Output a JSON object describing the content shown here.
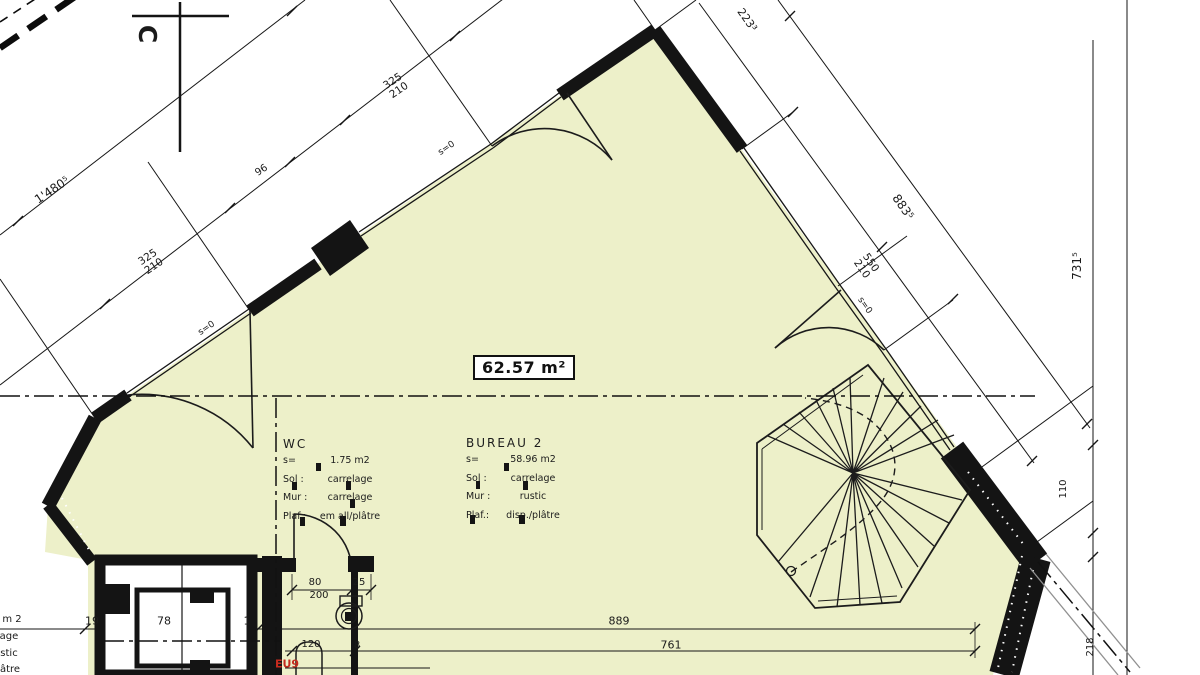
{
  "plan": {
    "area_box": "62.57 m²",
    "colors": {
      "floor": "#edf0c9",
      "line": "#161616",
      "gray": "#909090",
      "red": "#c52b1e",
      "paper": "#ffffff"
    },
    "rooms": {
      "wc": {
        "title": "WC",
        "rows": [
          [
            "s=",
            "1.75 m2"
          ],
          [
            "Sol :",
            "carrelage"
          ],
          [
            "Mur :",
            "carrelage"
          ],
          [
            "Plaf.:",
            "em all/plâtre"
          ]
        ]
      },
      "bureau": {
        "title": "BUREAU 2",
        "rows": [
          [
            "s=",
            "58.96 m2"
          ],
          [
            "Sol :",
            "carrelage"
          ],
          [
            "Mur :",
            "rustic"
          ],
          [
            "Plaf.:",
            "disp./plâtre"
          ]
        ]
      }
    },
    "dim_labels": [
      {
        "t": "C",
        "x": 147,
        "y": 34,
        "r": 90,
        "fs": 25,
        "b": 1,
        "n": "section-letter"
      },
      {
        "t": "1'480⁵",
        "x": 52,
        "y": 190,
        "r": -34,
        "fs": 12,
        "n": "dim-wall-total"
      },
      {
        "t": "325\n210",
        "x": 151,
        "y": 262,
        "r": -34,
        "fs": 10.5,
        "n": "dim-opening"
      },
      {
        "t": "96",
        "x": 262,
        "y": 171,
        "r": -34,
        "fs": 10,
        "n": "dim-opening"
      },
      {
        "t": "325\n210",
        "x": 396,
        "y": 86,
        "r": -34,
        "fs": 10.5,
        "n": "dim-opening"
      },
      {
        "t": "s=0",
        "x": 207,
        "y": 329,
        "r": -34,
        "fs": 9,
        "n": "sill-note"
      },
      {
        "t": "s=0",
        "x": 447,
        "y": 149,
        "r": -34,
        "fs": 9,
        "n": "sill-note"
      },
      {
        "t": "223³",
        "x": 747,
        "y": 20,
        "r": 55,
        "fs": 11,
        "n": "dim-wall"
      },
      {
        "t": "883⁵",
        "x": 903,
        "y": 207,
        "r": 55,
        "fs": 12,
        "n": "dim-wall"
      },
      {
        "t": "550\n210",
        "x": 866,
        "y": 266,
        "r": 55,
        "fs": 10.5,
        "n": "dim-opening"
      },
      {
        "t": "s=0",
        "x": 864,
        "y": 306,
        "r": 55,
        "fs": 9,
        "n": "sill-note"
      },
      {
        "t": "731⁵",
        "x": 1077,
        "y": 266,
        "r": -90,
        "fs": 12,
        "n": "dim-wall"
      },
      {
        "t": "110",
        "x": 1064,
        "y": 489,
        "r": -90,
        "fs": 10,
        "n": "dim-wall"
      },
      {
        "t": "218",
        "x": 1091,
        "y": 647,
        "r": -90,
        "fs": 10,
        "n": "dim-wall"
      },
      {
        "t": "19",
        "x": 92,
        "y": 621,
        "fs": 11,
        "n": "dim-bottom"
      },
      {
        "t": "78",
        "x": 164,
        "y": 621,
        "fs": 11,
        "n": "dim-bottom"
      },
      {
        "t": "1",
        "x": 247,
        "y": 621,
        "fs": 11,
        "n": "dim-bottom"
      },
      {
        "t": "889",
        "x": 619,
        "y": 621,
        "fs": 11,
        "n": "dim-bottom"
      },
      {
        "t": "761",
        "x": 671,
        "y": 645,
        "fs": 11,
        "n": "dim-bottom"
      },
      {
        "t": "80",
        "x": 315,
        "y": 583,
        "fs": 10,
        "n": "dim-door"
      },
      {
        "t": "200",
        "x": 319,
        "y": 596,
        "fs": 10,
        "n": "dim-door"
      },
      {
        "t": "25",
        "x": 359,
        "y": 583,
        "fs": 10,
        "n": "dim-door"
      },
      {
        "t": "120",
        "x": 311,
        "y": 645,
        "fs": 10,
        "n": "dim-fixture"
      },
      {
        "t": "8",
        "x": 357,
        "y": 646,
        "fs": 10,
        "n": "dim-fixture"
      },
      {
        "t": "EU9",
        "x": 287,
        "y": 664,
        "fs": 11,
        "b": 1,
        "c": "#c52b1e",
        "n": "drain-label"
      },
      {
        "t": "m 2",
        "x": 12,
        "y": 620,
        "fs": 10,
        "n": "cropped-room-text"
      },
      {
        "t": "age",
        "x": 9,
        "y": 637,
        "fs": 10,
        "n": "cropped-room-text"
      },
      {
        "t": "stic",
        "x": 9,
        "y": 654,
        "fs": 10,
        "n": "cropped-room-text"
      },
      {
        "t": "âtre",
        "x": 10,
        "y": 670,
        "fs": 10,
        "n": "cropped-room-text"
      }
    ]
  }
}
